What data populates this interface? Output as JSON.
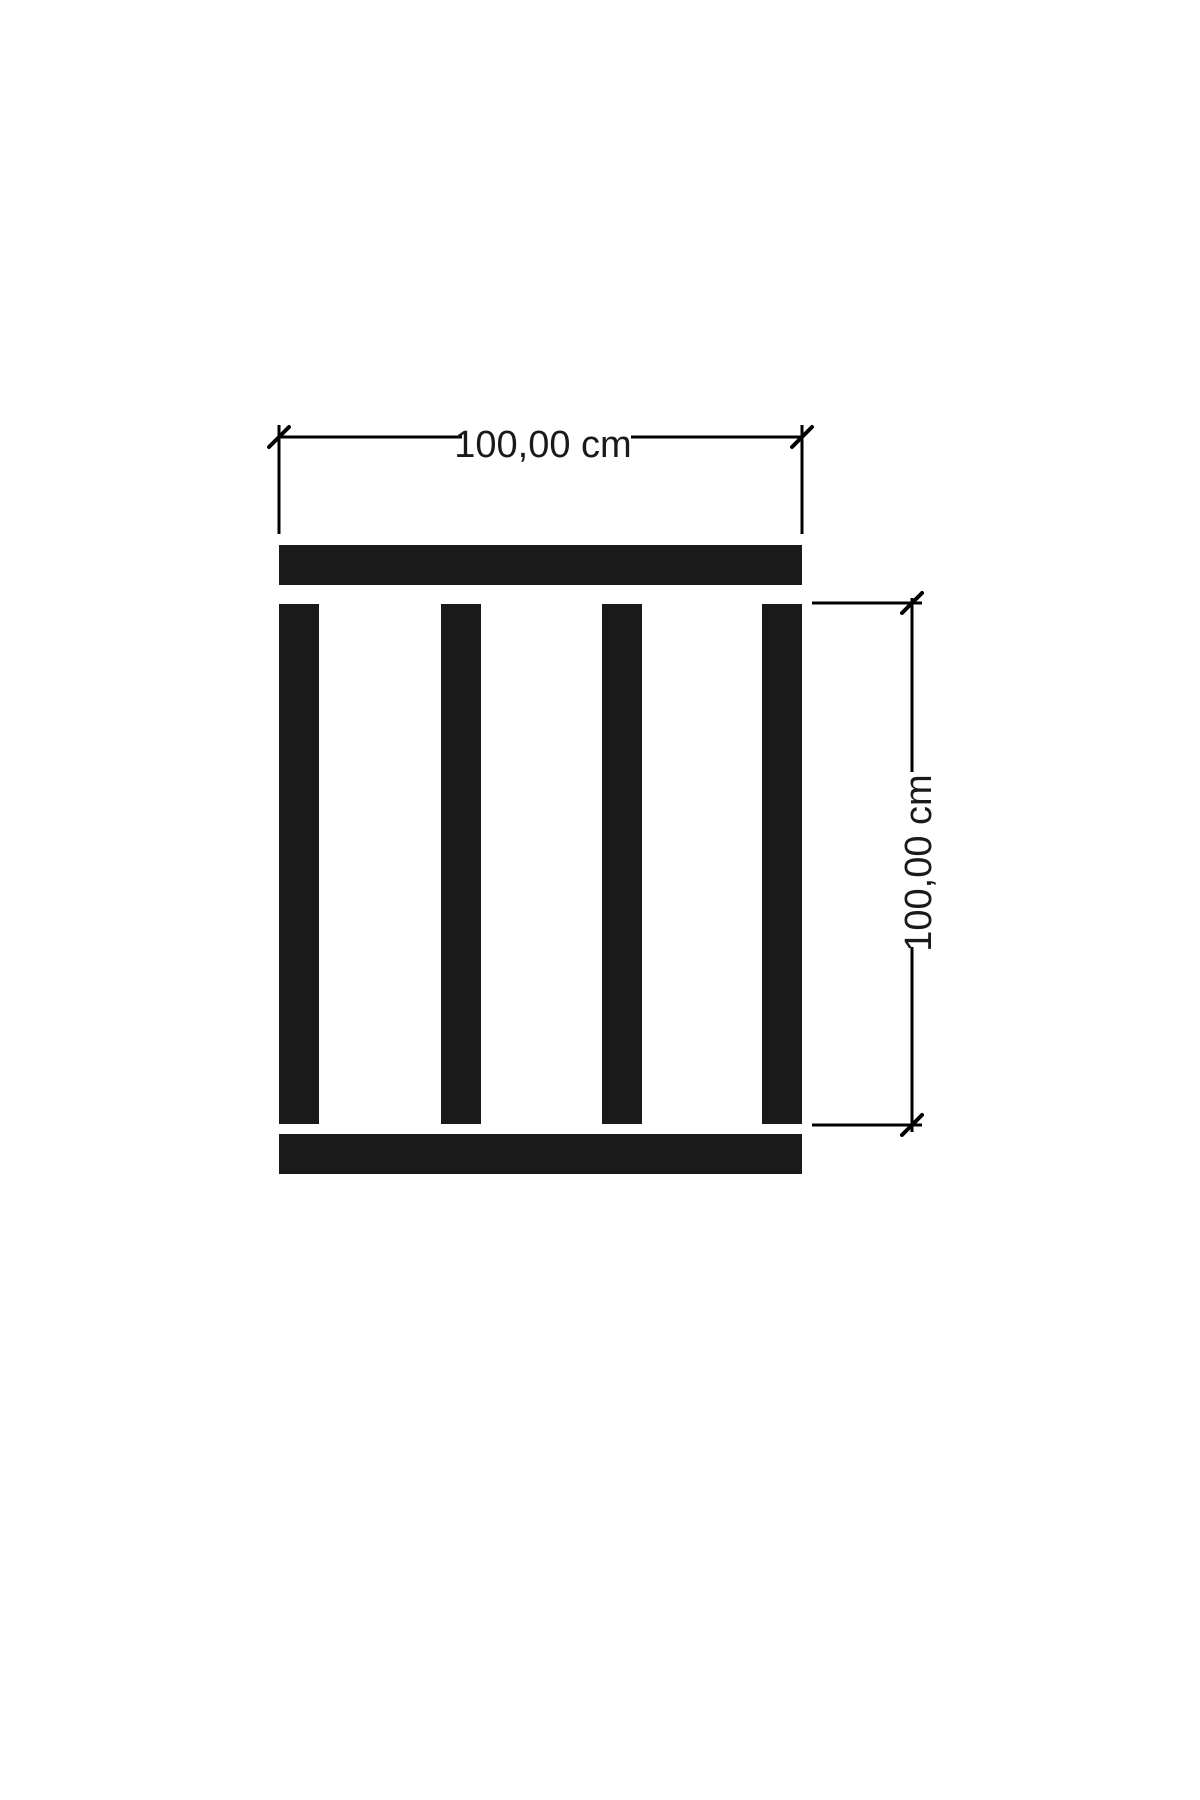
{
  "diagram": {
    "type": "technical-dimension-drawing",
    "subject": "slatted panel (pallet-style) front view with width and height dimensions",
    "canvas": {
      "width": 1200,
      "height": 1800
    },
    "colors": {
      "background": "#ffffff",
      "part_fill": "#1a1a1a",
      "ink": "#000000",
      "text": "#1a1a1a"
    },
    "labels": {
      "width_label": "100,00 cm",
      "height_label": "100,00 cm"
    },
    "dimensions": [
      {
        "axis": "horizontal",
        "value_cm": 100.0,
        "display": "100,00 cm"
      },
      {
        "axis": "vertical",
        "value_cm": 100.0,
        "display": "100,00 cm"
      }
    ],
    "rects": [
      {
        "name": "top-rail",
        "x": 279,
        "y": 545,
        "w": 523,
        "h": 40
      },
      {
        "name": "slat-1",
        "x": 279,
        "y": 604,
        "w": 40,
        "h": 520
      },
      {
        "name": "slat-2",
        "x": 441,
        "y": 604,
        "w": 40,
        "h": 520
      },
      {
        "name": "slat-3",
        "x": 602,
        "y": 604,
        "w": 40,
        "h": 520
      },
      {
        "name": "slat-4",
        "x": 762,
        "y": 604,
        "w": 40,
        "h": 520
      },
      {
        "name": "bottom-rail",
        "x": 279,
        "y": 1134,
        "w": 523,
        "h": 40
      }
    ],
    "lines": [
      {
        "name": "top-dimension-line-left",
        "x1": 279,
        "y1": 437,
        "x2": 462,
        "y2": 437,
        "w": 3
      },
      {
        "name": "top-dimension-line-right",
        "x1": 631,
        "y1": 437,
        "x2": 802,
        "y2": 437,
        "w": 3
      },
      {
        "name": "top-extension-line-left",
        "x1": 279,
        "y1": 425,
        "x2": 279,
        "y2": 534,
        "w": 3
      },
      {
        "name": "top-extension-line-right",
        "x1": 802,
        "y1": 425,
        "x2": 802,
        "y2": 534,
        "w": 3
      },
      {
        "name": "right-extension-line-top",
        "x1": 812,
        "y1": 603,
        "x2": 922,
        "y2": 603,
        "w": 3
      },
      {
        "name": "right-extension-line-bottom",
        "x1": 812,
        "y1": 1125,
        "x2": 922,
        "y2": 1125,
        "w": 3
      },
      {
        "name": "right-dimension-line-upper",
        "x1": 912,
        "y1": 598,
        "x2": 912,
        "y2": 772,
        "w": 3
      },
      {
        "name": "right-dimension-line-lower",
        "x1": 912,
        "y1": 947,
        "x2": 912,
        "y2": 1132,
        "w": 3
      }
    ],
    "ticks": [
      {
        "name": "tick-width-left",
        "cx": 279,
        "cy": 437
      },
      {
        "name": "tick-width-right",
        "cx": 802,
        "cy": 437
      },
      {
        "name": "tick-height-top",
        "cx": 912,
        "cy": 603
      },
      {
        "name": "tick-height-bottom",
        "cx": 912,
        "cy": 1125
      }
    ],
    "texts": [
      {
        "name": "width-dimension-label",
        "bind": "diagram.labels.width_label",
        "x": 543,
        "y": 447,
        "rotate": 0
      },
      {
        "name": "height-dimension-label",
        "bind": "diagram.labels.height_label",
        "x": 921,
        "y": 863,
        "rotate": -90
      }
    ]
  }
}
